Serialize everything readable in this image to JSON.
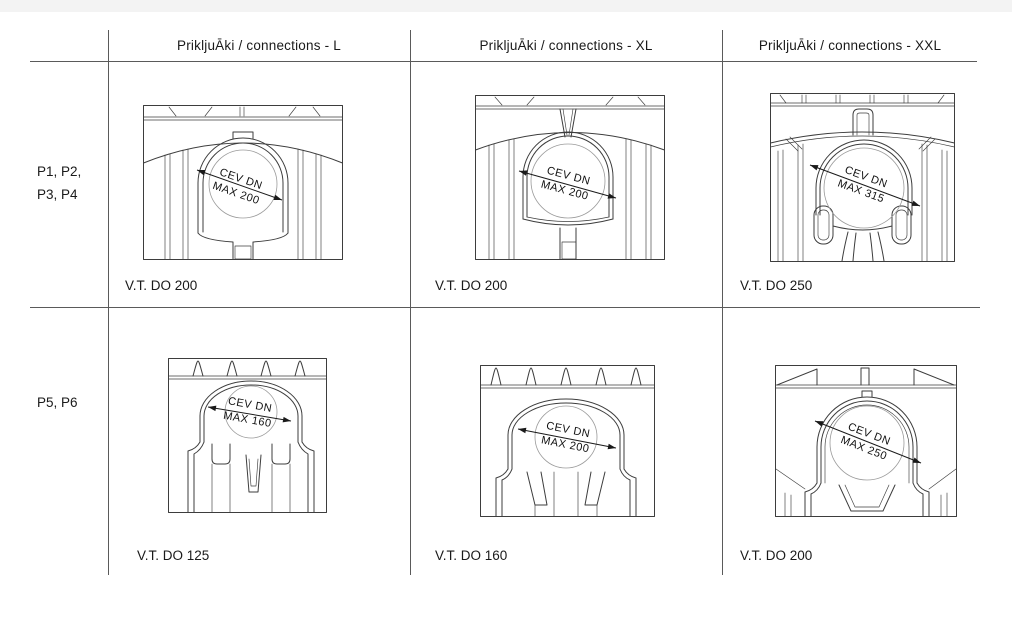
{
  "colors": {
    "grid_line": "#5a5a5a",
    "drawing_stroke": "#3d3d3d",
    "circle_stroke": "#9b9b9b",
    "text": "#1a1a1a",
    "top_strip": "#f3f3f3"
  },
  "table": {
    "headers": [
      {
        "label": "PrikljuĀki / connections - L"
      },
      {
        "label": "PrikljuĀki / connections - XL"
      },
      {
        "label": "PrikljuĀki / connections - XXL"
      }
    ],
    "rows": [
      {
        "label_lines": [
          "P1, P2,",
          "P3, P4"
        ],
        "cells": [
          {
            "dim_line1": "CEV DN",
            "dim_line2": "MAX 200",
            "caption": "V.T. DO 200"
          },
          {
            "dim_line1": "CEV DN",
            "dim_line2": "MAX 200",
            "caption": "V.T. DO 200"
          },
          {
            "dim_line1": "CEV DN",
            "dim_line2": "MAX 315",
            "caption": "V.T. DO 250"
          }
        ]
      },
      {
        "label_lines": [
          "P5, P6"
        ],
        "cells": [
          {
            "dim_line1": "CEV DN",
            "dim_line2": "MAX 160",
            "caption": "V.T. DO 125"
          },
          {
            "dim_line1": "CEV DN",
            "dim_line2": "MAX 200",
            "caption": "V.T. DO 160"
          },
          {
            "dim_line1": "CEV DN",
            "dim_line2": "MAX 250",
            "caption": "V.T. DO 200"
          }
        ]
      }
    ]
  }
}
